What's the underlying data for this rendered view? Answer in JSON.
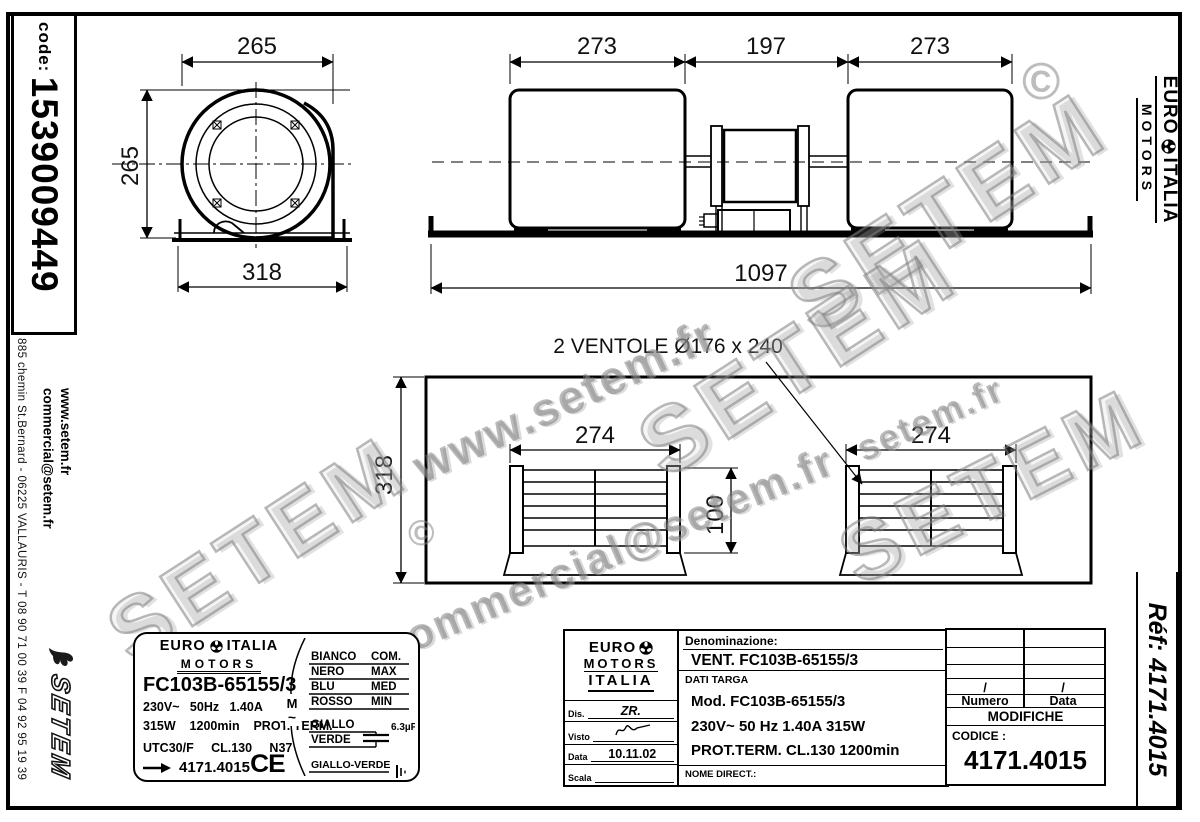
{
  "code": {
    "label": "code:",
    "value": "1539009449"
  },
  "left_margin": {
    "address": "885 chemin St.Bernard  -  06225 VALLAURIS  -  T 08 90 71 00 39  F 04 92 95 19 39",
    "website": "www.setem.fr",
    "email": "commercial@setem.fr",
    "setem_logo": "SETEM"
  },
  "brand": {
    "euro": "EURO",
    "italia": "ITALIA",
    "motors": "MOTORS"
  },
  "ref": {
    "label": "Réf:  4171.4015"
  },
  "watermarks": {
    "setem": "SETEM",
    "www": "www.setem.fr",
    "email": "commercial@setem.fr",
    "url_fragment": "setem.fr",
    "copyright": "©"
  },
  "drawings": {
    "side_view": {
      "dim_top": "265",
      "dim_left": "265",
      "dim_bottom": "318"
    },
    "front_view": {
      "dim_left": "273",
      "dim_mid": "197",
      "dim_right": "273",
      "dim_total": "1097"
    },
    "top_view": {
      "title": "2 VENTOLE Ø176 x 240",
      "dim_height": "318",
      "dim_grille_left": "274",
      "dim_grille_right": "274",
      "dim_depth": "100"
    }
  },
  "label": {
    "model": "FC103B-65155/3",
    "electrical": "230V~   50Hz   1.40A",
    "power": "315W    1200min    PROT. TERM.",
    "type": "UTC30/F     CL.130     N37",
    "code": "4171.4015",
    "ce": "CE",
    "motor_symbol": "M",
    "motor_tilde": "~",
    "capacitor": "6.3µF",
    "wiring": [
      {
        "color": "BIANCO",
        "value": "COM."
      },
      {
        "color": "NERO",
        "value": "MAX"
      },
      {
        "color": "BLU",
        "value": "MED"
      },
      {
        "color": "ROSSO",
        "value": "MIN"
      },
      {
        "color": "GIALLO",
        "value": ""
      },
      {
        "color": "VERDE",
        "value": ""
      },
      {
        "color": "GIALLO-VERDE",
        "value": ""
      }
    ]
  },
  "titleblock": {
    "denominazione_label": "Denominazione:",
    "denominazione_value": "VENT. FC103B-65155/3",
    "dati_targa": "DATI TARGA",
    "ce": "CE",
    "mod": "Mod.   FC103B-65155/3",
    "electrical": "230V~    50 Hz    1.40A     315W",
    "protection": "PROT.TERM.    CL.130    1200min",
    "nome_direct": "NOME DIRECT.:",
    "dis_label": "Dis.",
    "dis_value": "ZR.",
    "visto_label": "Visto",
    "data_label": "Data",
    "data_value": "10.11.02",
    "scala_label": "Scala"
  },
  "revisions": {
    "slash": "/",
    "numero": "Numero",
    "data": "Data",
    "modifiche": "MODIFICHE",
    "codice_label": "CODICE :",
    "codice_value": "4171.4015"
  }
}
